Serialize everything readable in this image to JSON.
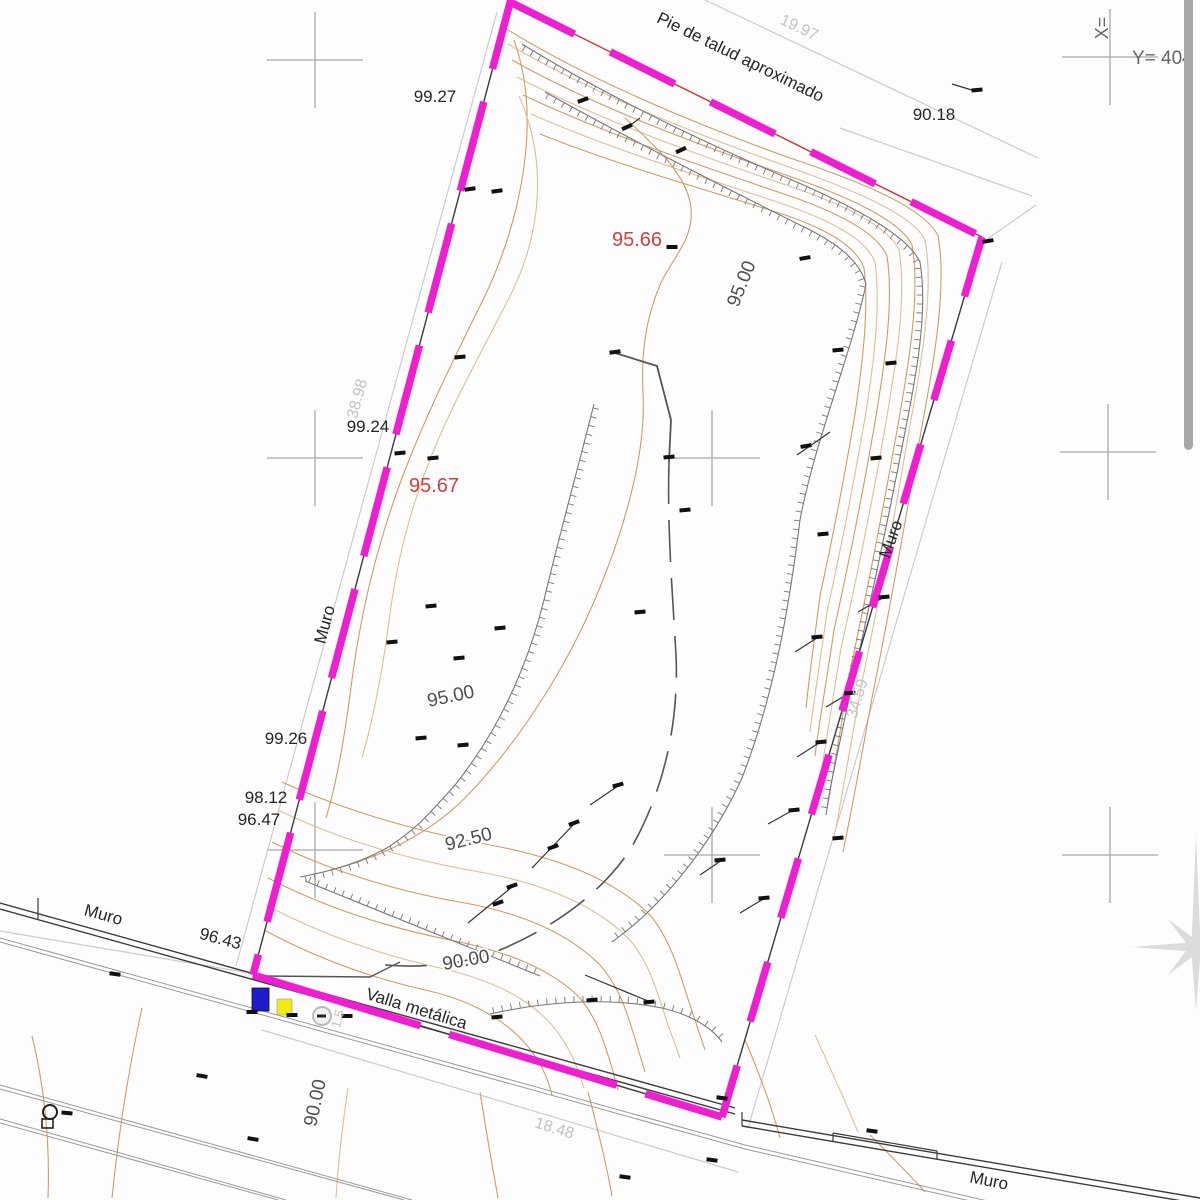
{
  "title": "Topographic site survey plan",
  "colors": {
    "background": "#fdfdfd",
    "boundary": "#ed1fd0",
    "boundary_top_underline": "#cc3333",
    "boundary_underline": "#3a3a3a",
    "wall": "#3a3a3a",
    "road": "#9a9a9a",
    "contour": "#cf9d62",
    "contour_light": "#dfbf96",
    "hatch": "#787878",
    "breakline": "#555555",
    "marker": "#111111",
    "cross": "#a8a8a8",
    "dim": "#cccccc",
    "dim_text": "#c3c3c3",
    "label_dark": "#262626",
    "label_red": "#cb4141",
    "label_contour": "#4f4f4f",
    "coord_text": "#666666",
    "scrollbar": "#a8a8a8",
    "star": "#dcdcdc",
    "blue_symbol": "#1d1dc9",
    "yellow_symbol": "#f2ea10"
  },
  "coordinate_refs": {
    "x_axis_label": "X=",
    "y_axis_label": "Y= 404"
  },
  "boundary_edges": [
    {
      "name": "left",
      "x1": 516,
      "y1": -20,
      "x2": 253,
      "y2": 975,
      "dash": "92 34",
      "under": "boundary_underline"
    },
    {
      "name": "top",
      "x1": 510,
      "y1": 2,
      "x2": 982,
      "y2": 237,
      "dash": "72 40",
      "under": "boundary_top_underline"
    },
    {
      "name": "right",
      "x1": 982,
      "y1": 237,
      "x2": 722,
      "y2": 1117,
      "dash": "62 46",
      "under": "boundary_underline"
    },
    {
      "name": "fence-bottom",
      "x1": 253,
      "y1": 975,
      "x2": 722,
      "y2": 1117,
      "dash": "175 30",
      "under": "boundary_underline"
    }
  ],
  "labels": [
    {
      "text": "Pie de talud aproximado",
      "x": 738,
      "y": 62,
      "rot": 26,
      "cls": "dark",
      "size": 17
    },
    {
      "text": "19.97",
      "x": 797,
      "y": 32,
      "rot": 26,
      "cls": "dim",
      "size": 16
    },
    {
      "text": "90.18",
      "x": 934,
      "y": 120,
      "rot": 0,
      "cls": "dark",
      "size": 17
    },
    {
      "text": "99.27",
      "x": 435,
      "y": 102,
      "rot": 0,
      "cls": "dark",
      "size": 17
    },
    {
      "text": "95.66",
      "x": 637,
      "y": 246,
      "rot": 0,
      "cls": "red",
      "size": 20
    },
    {
      "text": "95.00",
      "x": 747,
      "y": 286,
      "rot": -68,
      "cls": "contour",
      "size": 19
    },
    {
      "text": "99.24",
      "x": 368,
      "y": 432,
      "rot": 0,
      "cls": "dark",
      "size": 17
    },
    {
      "text": "38.98",
      "x": 362,
      "y": 400,
      "rot": -75,
      "cls": "dim",
      "size": 16
    },
    {
      "text": "95.67",
      "x": 434,
      "y": 492,
      "rot": 0,
      "cls": "red",
      "size": 20
    },
    {
      "text": "Muro",
      "x": 330,
      "y": 626,
      "rot": -75,
      "cls": "dark",
      "size": 17
    },
    {
      "text": "Muro",
      "x": 896,
      "y": 541,
      "rot": -70,
      "cls": "dark",
      "size": 17
    },
    {
      "text": "34.59",
      "x": 862,
      "y": 700,
      "rot": -73,
      "cls": "dim",
      "size": 16
    },
    {
      "text": "99.26",
      "x": 286,
      "y": 744,
      "rot": 0,
      "cls": "dark",
      "size": 17
    },
    {
      "text": "98.12",
      "x": 266,
      "y": 803,
      "rot": 0,
      "cls": "dark",
      "size": 17
    },
    {
      "text": "96.47",
      "x": 259,
      "y": 825,
      "rot": 0,
      "cls": "dark",
      "size": 17
    },
    {
      "text": "95.00",
      "x": 452,
      "y": 702,
      "rot": -12,
      "cls": "contour",
      "size": 19
    },
    {
      "text": "92.50",
      "x": 470,
      "y": 845,
      "rot": -14,
      "cls": "contour",
      "size": 19
    },
    {
      "text": "90.00",
      "x": 467,
      "y": 966,
      "rot": -10,
      "cls": "contour",
      "size": 19
    },
    {
      "text": "Muro",
      "x": 102,
      "y": 920,
      "rot": 15,
      "cls": "dark",
      "size": 17
    },
    {
      "text": "96.43",
      "x": 219,
      "y": 944,
      "rot": 15,
      "cls": "dark",
      "size": 17
    },
    {
      "text": "Valla metálica",
      "x": 415,
      "y": 1014,
      "rot": 17,
      "cls": "dark",
      "size": 17
    },
    {
      "text": "90.00",
      "x": 321,
      "y": 1104,
      "rot": -78,
      "cls": "contour",
      "size": 19
    },
    {
      "text": "18.48",
      "x": 553,
      "y": 1133,
      "rot": 17,
      "cls": "dim",
      "size": 16
    },
    {
      "text": "1.5",
      "x": 342,
      "y": 1020,
      "rot": -75,
      "cls": "dim",
      "size": 13
    },
    {
      "text": "Muro",
      "x": 988,
      "y": 1186,
      "rot": 11,
      "cls": "dark",
      "size": 17
    },
    {
      "text": "X=",
      "x": 1108,
      "y": 28,
      "rot": -90,
      "cls": "coord",
      "size": 18
    },
    {
      "text": "Y= 404",
      "x": 1132,
      "y": 64,
      "rot": 0,
      "cls": "coord",
      "size": 19,
      "anchor": "start"
    }
  ],
  "contours": [
    {
      "d": "M505,28 C585,78 690,122 790,158 C862,182 925,208 938,236 C948,290 932,372 918,448 C903,535 888,618 872,698 C860,765 850,818 843,852",
      "light": false
    },
    {
      "d": "M508,44 C590,92 690,132 786,166 C854,190 912,214 925,240 C935,292 920,370 907,442 C893,525 878,605 862,682 C851,746 842,795 836,828",
      "light": true
    },
    {
      "d": "M512,60 C594,106 691,142 783,174 C847,196 900,220 912,245 C921,295 908,368 896,436 C882,515 867,592 851,666 C841,727 833,772 828,804",
      "light": false
    },
    {
      "d": "M517,77 C600,120 693,153 780,183 C841,203 888,226 899,250 C907,298 896,364 885,428 C872,503 857,577 841,648 C832,705 825,748 820,780",
      "light": true
    },
    {
      "d": "M523,95 C606,134 696,164 778,192 C836,211 877,232 887,256 C894,302 885,362 875,422 C863,492 849,562 834,630 C826,684 819,724 815,756",
      "light": false
    },
    {
      "d": "M531,114 C613,150 700,176 777,202 C831,220 866,239 875,262 C881,306 874,362 865,418 C854,482 841,548 827,612 C820,662 814,700 810,732",
      "light": true
    },
    {
      "d": "M540,134 C620,166 704,189 776,212 C826,228 856,246 864,268 C869,308 863,360 855,414 C845,474 833,536 820,596 C814,642 809,678 806,708",
      "light": false
    },
    {
      "d": "M625,118 C662,152 688,178 691,208 C694,240 672,258 660,285 C646,318 641,352 643,392 C646,445 630,510 606,572 C576,652 526,735 465,798 C425,838 372,860 330,870",
      "light": false
    },
    {
      "d": "M514,40 C542,118 522,218 484,298 C452,362 424,420 402,478 C378,542 362,608 353,672 C346,728 338,778 326,818",
      "light": false
    },
    {
      "d": "M519,96 C548,162 541,232 512,292 C483,350 454,400 433,452 C411,506 397,560 390,614 C383,668 374,716 362,758",
      "light": true
    },
    {
      "d": "M282,782 C348,812 420,832 490,845 C560,858 615,880 650,915 C672,942 680,975 690,1005 L705,1050",
      "light": false
    },
    {
      "d": "M278,810 C340,840 410,860 480,872 C545,884 595,905 628,938 C650,962 658,995 668,1025 L680,1058",
      "light": true
    },
    {
      "d": "M272,842 C332,872 400,892 465,903 C525,914 570,935 600,965 C620,988 628,1015 636,1042 L645,1072",
      "light": false
    },
    {
      "d": "M268,878 C326,908 390,928 450,940 C510,952 552,970 580,998 C598,1020 605,1045 612,1068 L618,1090",
      "light": false
    },
    {
      "d": "M266,905 C322,935 382,955 440,968 C492,980 528,998 552,1025 C570,1047 578,1068 584,1088",
      "light": true
    },
    {
      "d": "M264,930 C316,958 372,978 425,990 C470,1000 502,1018 524,1042 C540,1060 548,1078 552,1095",
      "light": false
    },
    {
      "d": "M32,1036 C45,1090 50,1145 48,1198",
      "light": false
    },
    {
      "d": "M142,1008 C128,1072 118,1138 112,1198",
      "light": false
    },
    {
      "d": "M348,1088 C342,1128 338,1165 336,1198",
      "light": true
    },
    {
      "d": "M480,1092 C486,1130 492,1165 498,1198",
      "light": false
    },
    {
      "d": "M588,1092 C598,1130 606,1162 612,1196",
      "light": false
    },
    {
      "d": "M745,1040 C760,1075 772,1108 780,1138",
      "light": false
    },
    {
      "d": "M815,1035 C830,1068 845,1100 858,1132",
      "light": true
    },
    {
      "d": "M870,1135 C890,1155 910,1175 925,1192",
      "light": false
    }
  ],
  "hatched_lines": [
    {
      "d": "M522,44 C610,98 705,143 792,180 C857,208 908,236 920,262 C928,310 917,372 905,432 C891,505 876,577 860,648 C847,708 837,754 830,790 L826,815",
      "side": 1
    },
    {
      "d": "M545,92 C635,142 720,185 800,225 C840,244 860,262 866,284 C852,352 815,440 800,520 C790,600 776,690 742,778 C710,848 660,908 612,942",
      "side": 1
    },
    {
      "d": "M594,404 C577,472 558,540 544,600 C527,668 499,730 455,785 C424,820 414,830 390,846 C362,863 327,872 300,877",
      "side": -1
    },
    {
      "d": "M305,881 C390,916 470,948 540,976",
      "side": -1
    },
    {
      "d": "M490,1014 C552,1000 612,998 662,1008 C692,1015 712,1028 722,1042",
      "side": -1
    }
  ],
  "breaklines": {
    "solid": "M612,352 L657,366 L671,420 L669,462",
    "dashed": "M669,462 C667,530 673,600 676,655 C679,720 665,790 630,850 C600,895 550,930 495,952 C460,965 420,968 385,965",
    "corner": "M263,976 L370,977 L400,962"
  },
  "leaders": [
    [
      590,
      805,
      618,
      786
    ],
    [
      532,
      868,
      574,
      824
    ],
    [
      468,
      923,
      512,
      887
    ],
    [
      585,
      975,
      648,
      1001
    ],
    [
      797,
      455,
      830,
      432
    ],
    [
      858,
      612,
      886,
      596
    ],
    [
      795,
      652,
      820,
      636
    ],
    [
      826,
      707,
      851,
      692
    ],
    [
      797,
      757,
      822,
      741
    ],
    [
      768,
      824,
      795,
      809
    ],
    [
      700,
      875,
      722,
      860
    ],
    [
      740,
      913,
      765,
      898
    ],
    [
      952,
      84,
      975,
      91
    ],
    [
      640,
      118,
      628,
      127
    ]
  ],
  "markers": [
    [
      470,
      189,
      -8
    ],
    [
      497,
      191,
      -8
    ],
    [
      583,
      100,
      -20
    ],
    [
      627,
      127,
      -25
    ],
    [
      681,
      150,
      -25
    ],
    [
      672,
      247,
      0
    ],
    [
      805,
      258,
      -10
    ],
    [
      838,
      350,
      -5
    ],
    [
      891,
      363,
      -5
    ],
    [
      988,
      241,
      -10
    ],
    [
      977,
      90,
      -5
    ],
    [
      460,
      357,
      -5
    ],
    [
      400,
      453,
      -5
    ],
    [
      433,
      458,
      -5
    ],
    [
      392,
      642,
      -5
    ],
    [
      431,
      606,
      -5
    ],
    [
      459,
      658,
      -5
    ],
    [
      500,
      628,
      -5
    ],
    [
      421,
      738,
      -5
    ],
    [
      463,
      745,
      -5
    ],
    [
      615,
      352,
      -8
    ],
    [
      669,
      457,
      -5
    ],
    [
      685,
      510,
      -5
    ],
    [
      640,
      612,
      -5
    ],
    [
      618,
      785,
      -15
    ],
    [
      574,
      823,
      -20
    ],
    [
      553,
      847,
      -20
    ],
    [
      512,
      886,
      -20
    ],
    [
      498,
      903,
      -20
    ],
    [
      649,
      1002,
      -5
    ],
    [
      592,
      1000,
      -5
    ],
    [
      497,
      1017,
      -5
    ],
    [
      806,
      446,
      -10
    ],
    [
      876,
      458,
      -5
    ],
    [
      823,
      534,
      -5
    ],
    [
      884,
      597,
      -5
    ],
    [
      817,
      637,
      -5
    ],
    [
      850,
      693,
      -5
    ],
    [
      821,
      742,
      -5
    ],
    [
      794,
      810,
      -5
    ],
    [
      838,
      838,
      -5
    ],
    [
      720,
      860,
      -5
    ],
    [
      764,
      898,
      -5
    ],
    [
      347,
      1016,
      0
    ],
    [
      292,
      1015,
      0
    ],
    [
      252,
      1012,
      0
    ],
    [
      115,
      974,
      8
    ],
    [
      202,
      1076,
      10
    ],
    [
      67,
      1113,
      5
    ],
    [
      253,
      1139,
      10
    ],
    [
      625,
      1177,
      8
    ],
    [
      712,
      1160,
      8
    ],
    [
      722,
      1098,
      8
    ],
    [
      872,
      1131,
      8
    ]
  ],
  "grid_crosses": [
    [
      315,
      60
    ],
    [
      1110,
      57
    ],
    [
      315,
      458
    ],
    [
      712,
      458
    ],
    [
      1108,
      452
    ],
    [
      315,
      850
    ],
    [
      712,
      855
    ],
    [
      1110,
      855
    ]
  ],
  "dimension_lines": [
    [
      497,
      12,
      236,
      966
    ],
    [
      705,
      0,
      1038,
      158
    ],
    [
      840,
      128,
      1032,
      196
    ],
    [
      1036,
      205,
      986,
      240
    ],
    [
      1002,
      262,
      748,
      1128
    ],
    [
      262,
      1030,
      738,
      1172
    ],
    [
      0,
      931,
      250,
      973
    ]
  ],
  "road_lines": [
    {
      "x1": 0,
      "y1": 903,
      "x2": 735,
      "y2": 1108,
      "c": "wall",
      "w": 1.4
    },
    {
      "x1": 0,
      "y1": 909,
      "x2": 735,
      "y2": 1114,
      "c": "wall",
      "w": 1.4
    },
    {
      "x1": 38,
      "y1": 898,
      "x2": 38,
      "y2": 920,
      "c": "wall",
      "w": 1.2
    },
    {
      "d": "M0,938 L745,1145 L1200,1250",
      "c": "road",
      "w": 1
    },
    {
      "d": "M0,942 L745,1149 L1200,1254",
      "c": "road",
      "w": 1
    },
    {
      "x1": 0,
      "y1": 1085,
      "x2": 412,
      "y2": 1200,
      "c": "road",
      "w": 1
    },
    {
      "x1": 0,
      "y1": 1089,
      "x2": 404,
      "y2": 1200,
      "c": "road",
      "w": 1
    },
    {
      "x1": 0,
      "y1": 1119,
      "x2": 286,
      "y2": 1200,
      "c": "road",
      "w": 1
    },
    {
      "x1": 0,
      "y1": 1123,
      "x2": 278,
      "y2": 1200,
      "c": "road",
      "w": 1
    },
    {
      "x1": 742,
      "y1": 1120,
      "x2": 1200,
      "y2": 1198,
      "c": "wall",
      "w": 1.4
    },
    {
      "x1": 742,
      "y1": 1126,
      "x2": 1200,
      "y2": 1204,
      "c": "wall",
      "w": 1.4
    },
    {
      "x1": 742,
      "y1": 1112,
      "x2": 742,
      "y2": 1126,
      "c": "wall",
      "w": 1.2
    },
    {
      "x1": 833,
      "y1": 1133,
      "x2": 937,
      "y2": 1151,
      "c": "wall",
      "w": 1.2
    },
    {
      "x1": 833,
      "y1": 1133,
      "x2": 833,
      "y2": 1141,
      "c": "wall",
      "w": 1.2
    },
    {
      "x1": 937,
      "y1": 1151,
      "x2": 937,
      "y2": 1159,
      "c": "wall",
      "w": 1.2
    }
  ],
  "symbols": {
    "blue_rect": {
      "x": 252,
      "y": 988,
      "w": 17,
      "h": 23
    },
    "yellow_rect": {
      "x": 277,
      "y": 999,
      "w": 15,
      "h": 16
    },
    "ring": {
      "cx": 322,
      "cy": 1016,
      "r": 9
    },
    "lamp": {
      "cx": 50,
      "cy": 1112,
      "r": 7,
      "bx": 42,
      "by": 1119,
      "bw": 11,
      "bh": 9
    },
    "star": {
      "cx": 1196,
      "cy": 947,
      "r_west": 112,
      "r_card": 64,
      "r_diag": 40,
      "r_inner": 11
    },
    "scrollbar": {
      "x": 1184,
      "y": -8,
      "w": 9,
      "h": 458
    }
  }
}
